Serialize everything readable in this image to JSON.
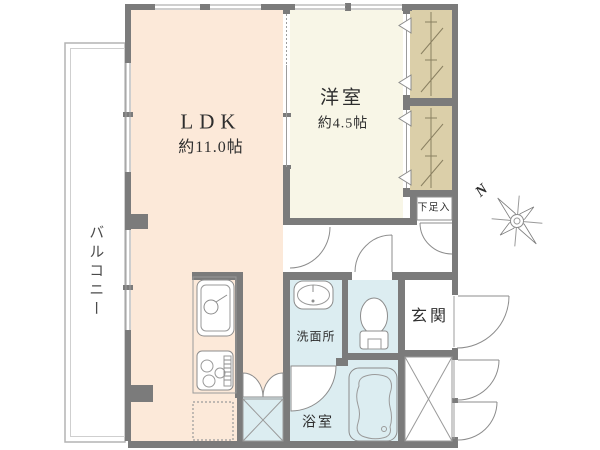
{
  "plan": {
    "rooms": {
      "ldk": {
        "label": "LDK",
        "area": "約11.0帖"
      },
      "western_room": {
        "label": "洋室",
        "area": "約4.5帖"
      },
      "balcony": {
        "label": "バルコニー"
      },
      "entrance": {
        "label": "玄関"
      },
      "washroom": {
        "label": "洗面所"
      },
      "bathroom": {
        "label": "浴室"
      },
      "shoe_cabinet": {
        "label": "下足入"
      }
    },
    "compass": {
      "north_label": "N"
    },
    "colors": {
      "ldk_fill": "#fce9d9",
      "western_fill": "#f8f6e7",
      "closet_fill": "#dbcfa9",
      "wet_area_fill": "#dcedf1",
      "wall": "#7b7b7b"
    }
  }
}
